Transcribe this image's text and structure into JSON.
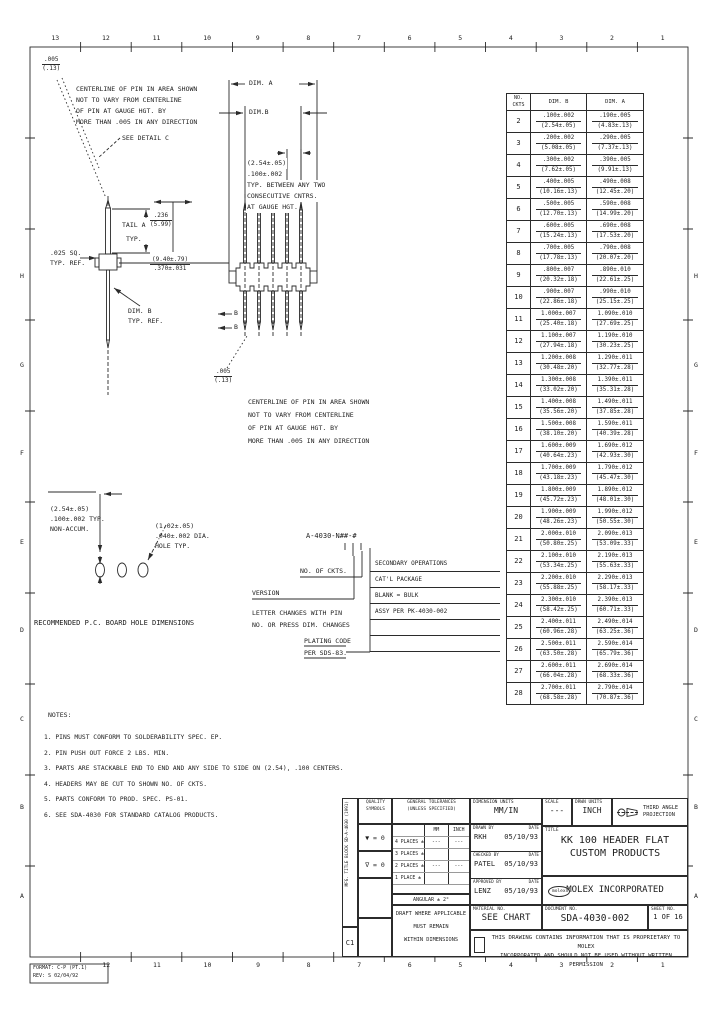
{
  "border": {
    "top_numbers": [
      "13",
      "12",
      "11",
      "10",
      "9",
      "8",
      "7",
      "6",
      "5",
      "4",
      "3",
      "2",
      "1"
    ],
    "bottom_numbers": [
      "12",
      "11",
      "10",
      "9",
      "8",
      "7",
      "6",
      "5",
      "4",
      "3",
      "2",
      "1"
    ],
    "left_letters": [
      "H",
      "G",
      "F",
      "E",
      "D",
      "C",
      "B",
      "A"
    ],
    "right_letters": [
      "H",
      "G",
      "F",
      "E",
      "D",
      "C",
      "B",
      "A"
    ],
    "corner_stamp_line1": "FORMAT: C-P (PT.1)",
    "corner_stamp_line2": "REV: S 02/04/92"
  },
  "callouts": {
    "tol_frac_top": ".005",
    "tol_frac_bot": "(.13)",
    "centerline_note": [
      "CENTERLINE OF PIN IN AREA SHOWN",
      "NOT TO VARY FROM CENTERLINE",
      "OF PIN AT GAUGE HGT. BY",
      "MORE THAN .005 IN ANY DIRECTION"
    ],
    "see_detail": "SEE DETAIL C",
    "dim_a": "DIM. A",
    "dim_b": "DIM.B",
    "pitch_note": [
      "(2.54±.05)",
      ".100±.002",
      "TYP. BETWEEN ANY TWO",
      "CONSECUTIVE CNTRS.",
      "AT GAUGE HGT."
    ],
    "tail_label": "TAIL A",
    "tail_top": ".236",
    "tail_bot": "(5.99)",
    "tail_typ": "TYP.",
    "sq_label_1": ".025 SQ.",
    "sq_label_2": "TYP. REF.",
    "dim_ref_1": "DIM. B",
    "dim_ref_2": "TYP. REF.",
    "mid_dim_top": "(9.40±.79)",
    "mid_dim_bot": ".370±.031",
    "section_b": "B"
  },
  "pcb": {
    "dim1": [
      "(2.54±.05)",
      ".100±.002 TYP.",
      "NON-ACCUM."
    ],
    "dim2": [
      "(1.02±.05)",
      ".040±.002 DIA.",
      "HOLE TYP."
    ],
    "caption": "RECOMMENDED P.C. BOARD HOLE DIMENSIONS"
  },
  "part_number": {
    "callout": "A-4030-N##-#",
    "no_of_ckts": "NO. OF CKTS.",
    "version": "VERSION",
    "letter_note_1": "LETTER CHANGES WITH PIN",
    "letter_note_2": "NO. OR PRESS DIM. CHANGES",
    "right_rows": [
      "SECONDARY OPERATIONS",
      "CAT'L PACKAGE",
      "BLANK = BULK",
      "ASSY PER PK-4030-002",
      "",
      ""
    ],
    "plating_1": "PLATING CODE",
    "plating_2": "PER SDS-83."
  },
  "size_table": {
    "header": {
      "no_line1": "NO.",
      "no_line2": "CKTS",
      "dim_b": "DIM. B",
      "dim_a": "DIM. A"
    },
    "rows": [
      {
        "n": "2",
        "b1": ".100±.002",
        "b2": "(2.54±.05)",
        "a1": ".190±.005",
        "a2": "(4.83±.13)"
      },
      {
        "n": "3",
        "b1": ".200±.002",
        "b2": "(5.08±.05)",
        "a1": ".290±.005",
        "a2": "(7.37±.13)"
      },
      {
        "n": "4",
        "b1": ".300±.002",
        "b2": "(7.62±.05)",
        "a1": ".390±.005",
        "a2": "(9.91±.13)"
      },
      {
        "n": "5",
        "b1": ".400±.005",
        "b2": "(10.16±.13)",
        "a1": ".490±.008",
        "a2": "(12.45±.20)"
      },
      {
        "n": "6",
        "b1": ".500±.005",
        "b2": "(12.70±.13)",
        "a1": ".590±.008",
        "a2": "(14.99±.20)"
      },
      {
        "n": "7",
        "b1": ".600±.005",
        "b2": "(15.24±.13)",
        "a1": ".690±.008",
        "a2": "(17.53±.20)"
      },
      {
        "n": "8",
        "b1": ".700±.005",
        "b2": "(17.78±.13)",
        "a1": ".790±.008",
        "a2": "(20.07±.20)"
      },
      {
        "n": "9",
        "b1": ".800±.007",
        "b2": "(20.32±.18)",
        "a1": ".890±.010",
        "a2": "(22.61±.25)"
      },
      {
        "n": "10",
        "b1": ".900±.007",
        "b2": "(22.86±.18)",
        "a1": ".990±.010",
        "a2": "(25.15±.25)"
      },
      {
        "n": "11",
        "b1": "1.000±.007",
        "b2": "(25.40±.18)",
        "a1": "1.090±.010",
        "a2": "(27.69±.25)"
      },
      {
        "n": "12",
        "b1": "1.100±.007",
        "b2": "(27.94±.18)",
        "a1": "1.190±.010",
        "a2": "(30.23±.25)"
      },
      {
        "n": "13",
        "b1": "1.200±.008",
        "b2": "(30.48±.20)",
        "a1": "1.290±.011",
        "a2": "(32.77±.28)"
      },
      {
        "n": "14",
        "b1": "1.300±.008",
        "b2": "(33.02±.20)",
        "a1": "1.390±.011",
        "a2": "(35.31±.28)"
      },
      {
        "n": "15",
        "b1": "1.400±.008",
        "b2": "(35.56±.20)",
        "a1": "1.490±.011",
        "a2": "(37.85±.28)"
      },
      {
        "n": "16",
        "b1": "1.500±.008",
        "b2": "(38.10±.20)",
        "a1": "1.590±.011",
        "a2": "(40.39±.28)"
      },
      {
        "n": "17",
        "b1": "1.600±.009",
        "b2": "(40.64±.23)",
        "a1": "1.690±.012",
        "a2": "(42.93±.30)"
      },
      {
        "n": "18",
        "b1": "1.700±.009",
        "b2": "(43.18±.23)",
        "a1": "1.790±.012",
        "a2": "(45.47±.30)"
      },
      {
        "n": "19",
        "b1": "1.800±.009",
        "b2": "(45.72±.23)",
        "a1": "1.890±.012",
        "a2": "(48.01±.30)"
      },
      {
        "n": "20",
        "b1": "1.900±.009",
        "b2": "(48.26±.23)",
        "a1": "1.990±.012",
        "a2": "(50.55±.30)"
      },
      {
        "n": "21",
        "b1": "2.000±.010",
        "b2": "(50.80±.25)",
        "a1": "2.090±.013",
        "a2": "(53.09±.33)"
      },
      {
        "n": "22",
        "b1": "2.100±.010",
        "b2": "(53.34±.25)",
        "a1": "2.190±.013",
        "a2": "(55.63±.33)"
      },
      {
        "n": "23",
        "b1": "2.200±.010",
        "b2": "(55.88±.25)",
        "a1": "2.290±.013",
        "a2": "(58.17±.33)"
      },
      {
        "n": "24",
        "b1": "2.300±.010",
        "b2": "(58.42±.25)",
        "a1": "2.390±.013",
        "a2": "(60.71±.33)"
      },
      {
        "n": "25",
        "b1": "2.400±.011",
        "b2": "(60.96±.28)",
        "a1": "2.490±.014",
        "a2": "(63.25±.36)"
      },
      {
        "n": "26",
        "b1": "2.500±.011",
        "b2": "(63.50±.28)",
        "a1": "2.590±.014",
        "a2": "(65.79±.36)"
      },
      {
        "n": "27",
        "b1": "2.600±.011",
        "b2": "(66.04±.28)",
        "a1": "2.690±.014",
        "a2": "(68.33±.36)"
      },
      {
        "n": "28",
        "b1": "2.700±.011",
        "b2": "(68.58±.28)",
        "a1": "2.790±.014",
        "a2": "(70.87±.36)"
      }
    ]
  },
  "notes": {
    "header": "NOTES:",
    "items": [
      "1. PINS MUST CONFORM TO SOLDERABILITY SPEC. EP.",
      "2. PIN PUSH OUT FORCE 2 LBS. MIN.",
      "3. PARTS ARE STACKABLE END TO END AND ANY SIDE TO SIDE ON (2.54), .100 CENTERS.",
      "4. HEADERS MAY BE CUT TO SHOWN NO. OF CKTS.",
      "5. PARTS CONFORM TO PROD. SPEC. PS-01.",
      "6. SEE SDA-4030 FOR STANDARD CATALOG PRODUCTS."
    ]
  },
  "title_block": {
    "strip_line1": "MFG. TITLE BLOCK",
    "strip_line2": "SD-A-4030 (1991)",
    "size_letter": "C1",
    "quality": {
      "header1": "QUALITY",
      "header2": "SYMBOLS",
      "sym1": "▼ = 0",
      "sym2": "∇ = 0"
    },
    "tolerances": {
      "header1": "GENERAL TOLERANCES",
      "header2": "(UNLESS SPECIFIED)",
      "col_mm": "MM",
      "col_inch": "INCH",
      "rows": [
        {
          "label": "4 PLACES ±",
          "mm": "---",
          "inch": "---"
        },
        {
          "label": "3 PLACES ±",
          "mm": "",
          "inch": ""
        },
        {
          "label": "2 PLACES ±",
          "mm": "---",
          "inch": "---"
        },
        {
          "label": "1 PLACE ±",
          "mm": "",
          "inch": ""
        }
      ],
      "angular": "ANGULAR ± 2°"
    },
    "dim_units": {
      "label": "DIMENSION UNITS",
      "value": "MM/IN"
    },
    "scale": {
      "label": "SCALE",
      "value": "---"
    },
    "drwn_units": {
      "label": "DRWN UNITS",
      "value": "INCH"
    },
    "projection": {
      "line1": "THIRD ANGLE",
      "line2": "PROJECTION"
    },
    "personnel": [
      {
        "label": "DRAWN BY",
        "date_label": "DATE",
        "name": "RKH",
        "date": "05/10/93"
      },
      {
        "label": "CHECKED BY",
        "date_label": "DATE",
        "name": "PATEL",
        "date": "05/10/93"
      },
      {
        "label": "APPROVED BY",
        "date_label": "DATE",
        "name": "LENZ",
        "date": "05/10/93"
      }
    ],
    "title": {
      "label": "TITLE",
      "line1": "KK 100 HEADER FLAT",
      "line2": "CUSTOM PRODUCTS"
    },
    "company": {
      "logo": "molex",
      "name": "MOLEX INCORPORATED"
    },
    "material": {
      "label": "MATERIAL NO.",
      "value": "SEE CHART"
    },
    "document": {
      "label": "DOCUMENT NO.",
      "value": "SDA-4030-002"
    },
    "sheet": {
      "label": "SHEET NO.",
      "value": "1 OF 16"
    },
    "draft_note": [
      "DRAFT WHERE APPLICABLE",
      "MUST REMAIN",
      "WITHIN DIMENSIONS"
    ],
    "proprietary_line1": "THIS DRAWING CONTAINS INFORMATION THAT IS PROPRIETARY TO MOLEX",
    "proprietary_line2": "INCORPORATED AND SHOULD NOT BE USED WITHOUT WRITTEN PERMISSION"
  }
}
